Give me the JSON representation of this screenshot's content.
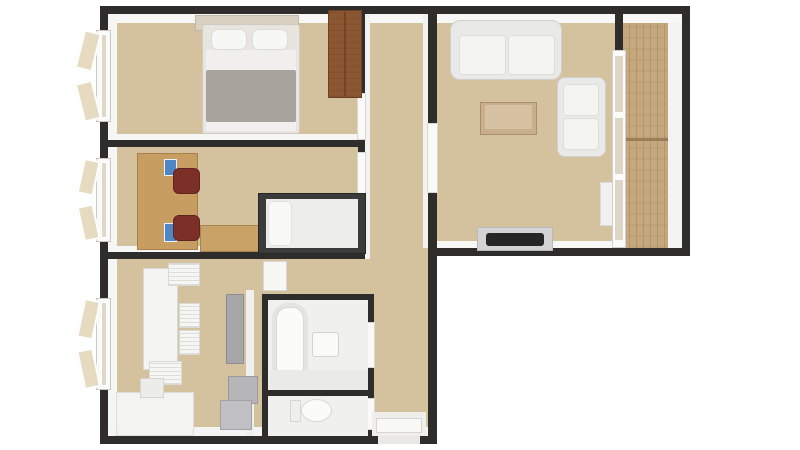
{
  "meta": {
    "description": "3D rendered top-down apartment floor plan, L-shaped layout, no visible text",
    "canvas": {
      "width": 800,
      "height": 450
    }
  },
  "palette": {
    "background": "#ffffff",
    "wall": "#2e2d2b",
    "wall_face": "#f5f5f3",
    "floor": "#d4c29e",
    "balcony_wood": "#c6a87f",
    "furniture_white": "#f4f4f2",
    "wardrobe_brown": "#8a5732",
    "desk_wood": "#c89d61",
    "chair_maroon": "#7c2f27",
    "accent_blue": "#4f86c6",
    "blanket_gray": "#a8a39c",
    "appliance_gray": "#a7a7a9",
    "tv_black": "#262626"
  },
  "rooms": [
    {
      "id": "bedroom",
      "position": "top-left",
      "furniture": [
        "double-bed",
        "two-pillows",
        "gray-blanket",
        "headboard-shelf",
        "wardrobe",
        "casement-window"
      ]
    },
    {
      "id": "study",
      "position": "middle-left",
      "furniture": [
        "long-desk",
        "two-maroon-office-chairs",
        "blue-desk-items",
        "single-bed-dark-frame",
        "wooden-chest",
        "casement-window"
      ]
    },
    {
      "id": "kitchen",
      "position": "bottom-left",
      "furniture": [
        "white-dining-table",
        "four-white-chairs",
        "kitchen-counter",
        "sink-unit",
        "fridge",
        "appliance-boxes",
        "casement-window"
      ]
    },
    {
      "id": "bathroom",
      "position": "bottom-center",
      "furniture": [
        "bathtub",
        "sink",
        "vanity-shelf"
      ]
    },
    {
      "id": "wc",
      "position": "bottom-center-lower",
      "furniture": [
        "toilet"
      ]
    },
    {
      "id": "hallway",
      "position": "center",
      "furniture": [
        "open-door-panels",
        "entrance-door"
      ]
    },
    {
      "id": "living-room",
      "position": "top-right",
      "furniture": [
        "three-seat-sofa",
        "coffee-table",
        "armchair",
        "tv-on-stand",
        "window-sill-cabinet"
      ]
    },
    {
      "id": "balcony",
      "position": "far-right",
      "furniture": [
        "wood-plank-floor",
        "glass-wall",
        "railing"
      ]
    }
  ],
  "elements": [
    {
      "name": "floor-main",
      "x": 108,
      "y": 14,
      "w": 320,
      "h": 422,
      "fill": "#d4c29e"
    },
    {
      "name": "floor-living",
      "x": 437,
      "y": 14,
      "w": 178,
      "h": 234,
      "fill": "#d4c29e"
    },
    {
      "name": "floor-balcony-wood",
      "x": 622,
      "y": 22,
      "w": 46,
      "h": 226,
      "fill": "#c6a87f",
      "texture": "planks"
    },
    {
      "name": "balcony-railing-face",
      "x": 668,
      "y": 16,
      "w": 14,
      "h": 232,
      "fill": "#f3f3f2"
    },
    {
      "name": "balcony-plank-divider",
      "x": 622,
      "y": 138,
      "w": 46,
      "h": 3,
      "fill": "#9b7e59"
    },
    {
      "name": "wall-face-top",
      "x": 108,
      "y": 14,
      "w": 574,
      "h": 9,
      "fill": "#f7f7f5"
    },
    {
      "name": "wall-face-left",
      "x": 108,
      "y": 14,
      "w": 9,
      "h": 422,
      "fill": "#f5f5f3"
    },
    {
      "name": "wall-face-bottom",
      "x": 108,
      "y": 427,
      "w": 320,
      "h": 9,
      "fill": "#f4f4f2"
    },
    {
      "name": "wall-face-living-bottom",
      "x": 437,
      "y": 241,
      "w": 178,
      "h": 7,
      "fill": "#f7f7f5"
    },
    {
      "name": "wall-face-bedroom-study",
      "x": 108,
      "y": 134,
      "w": 250,
      "h": 6,
      "fill": "#f6f6f4"
    },
    {
      "name": "wall-face-study-kitchen",
      "x": 108,
      "y": 246,
      "w": 250,
      "h": 6,
      "fill": "#f6f6f4"
    },
    {
      "name": "wall-face-hall-left",
      "x": 365,
      "y": 14,
      "w": 5,
      "h": 245,
      "fill": "#f2f2f0"
    },
    {
      "name": "wall-face-hall-right",
      "x": 423,
      "y": 14,
      "w": 5,
      "h": 234,
      "fill": "#f2f2f0"
    },
    {
      "name": "wall-face-kitchen-partition",
      "x": 246,
      "y": 290,
      "w": 8,
      "h": 146,
      "fill": "#efefed"
    },
    {
      "name": "wall-top",
      "x": 100,
      "y": 6,
      "w": 590,
      "h": 8
    },
    {
      "name": "wall-left",
      "x": 100,
      "y": 6,
      "w": 8,
      "h": 438
    },
    {
      "name": "wall-bottom",
      "x": 100,
      "y": 436,
      "w": 337,
      "h": 8
    },
    {
      "name": "wall-hall-right-full",
      "x": 428,
      "y": 14,
      "w": 9,
      "h": 430
    },
    {
      "name": "wall-bottom-right-block",
      "x": 428,
      "y": 248,
      "w": 262,
      "h": 8
    },
    {
      "name": "wall-right-outer",
      "x": 682,
      "y": 6,
      "w": 8,
      "h": 250
    },
    {
      "name": "wall-bedroom-study",
      "x": 108,
      "y": 140,
      "w": 250,
      "h": 7
    },
    {
      "name": "wall-study-kitchen",
      "x": 108,
      "y": 252,
      "w": 250,
      "h": 7
    },
    {
      "name": "wall-hall-left",
      "x": 358,
      "y": 14,
      "w": 7,
      "h": 245
    },
    {
      "name": "wall-balcony-stub",
      "x": 615,
      "y": 6,
      "w": 8,
      "h": 44
    },
    {
      "name": "wall-bath-top",
      "x": 262,
      "y": 294,
      "w": 112,
      "h": 6
    },
    {
      "name": "wall-bath-left",
      "x": 262,
      "y": 294,
      "w": 6,
      "h": 142
    },
    {
      "name": "wall-bath-right",
      "x": 368,
      "y": 294,
      "w": 6,
      "h": 142
    },
    {
      "name": "wall-bath-divider",
      "x": 262,
      "y": 390,
      "w": 112,
      "h": 6
    },
    {
      "name": "door-bedroom-panel",
      "x": 357,
      "y": 93,
      "w": 9,
      "h": 47,
      "fill": "#f9f9f8",
      "stroke": "#d8d8d6"
    },
    {
      "name": "door-study-panel",
      "x": 357,
      "y": 152,
      "w": 9,
      "h": 42,
      "fill": "#f9f9f8",
      "stroke": "#d8d8d6"
    },
    {
      "name": "door-living-panel",
      "x": 427,
      "y": 123,
      "w": 11,
      "h": 70,
      "fill": "#f9f9f8",
      "stroke": "#d8d8d6"
    },
    {
      "name": "door-bathroom-panel",
      "x": 366,
      "y": 322,
      "w": 9,
      "h": 46,
      "fill": "#f9f9f8",
      "stroke": "#d8d8d6"
    },
    {
      "name": "door-wc-panel",
      "x": 366,
      "y": 398,
      "w": 9,
      "h": 32,
      "fill": "#f9f9f8",
      "stroke": "#d8d8d6"
    },
    {
      "name": "hall-open-door-panel",
      "x": 263,
      "y": 261,
      "w": 24,
      "h": 30,
      "fill": "#f7f7f5",
      "stroke": "#d8d8d6"
    },
    {
      "name": "entrance-floor",
      "x": 372,
      "y": 412,
      "w": 54,
      "h": 24,
      "fill": "#efeeea"
    },
    {
      "name": "entrance-door-panel",
      "x": 376,
      "y": 418,
      "w": 46,
      "h": 15,
      "fill": "#f8f8f7",
      "stroke": "#d5d5d3"
    },
    {
      "name": "entrance-threshold",
      "x": 378,
      "y": 436,
      "w": 42,
      "h": 8,
      "fill": "#e9e8e5"
    },
    {
      "name": "bedroom-window-frame",
      "x": 96,
      "y": 30,
      "w": 15,
      "h": 92,
      "fill": "#fafaf9",
      "stroke": "#c9c9c7"
    },
    {
      "name": "bedroom-window-glass",
      "x": 101,
      "y": 34,
      "w": 6,
      "h": 84,
      "fill": "#dfd8c6",
      "stroke": "#ffffff"
    },
    {
      "name": "bedroom-window-sash-top",
      "x": 79,
      "y": 33,
      "w": 18,
      "h": 40,
      "fill": "#e6dac1",
      "stroke": "#ffffff",
      "bw": 2,
      "rot": 14
    },
    {
      "name": "bedroom-window-sash-bottom",
      "x": 79,
      "y": 79,
      "w": 18,
      "h": 40,
      "fill": "#e6dac1",
      "stroke": "#ffffff",
      "bw": 2,
      "rot": -14
    },
    {
      "name": "study-window-frame",
      "x": 96,
      "y": 158,
      "w": 15,
      "h": 84,
      "fill": "#fafaf9",
      "stroke": "#c9c9c7"
    },
    {
      "name": "study-window-glass",
      "x": 101,
      "y": 162,
      "w": 6,
      "h": 76,
      "fill": "#dfd8c6",
      "stroke": "#ffffff"
    },
    {
      "name": "study-window-sash-top",
      "x": 80,
      "y": 161,
      "w": 17,
      "h": 36,
      "fill": "#e6dac1",
      "stroke": "#ffffff",
      "bw": 2,
      "rot": 12
    },
    {
      "name": "study-window-sash-bottom",
      "x": 80,
      "y": 203,
      "w": 17,
      "h": 36,
      "fill": "#e6dac1",
      "stroke": "#ffffff",
      "bw": 2,
      "rot": -12
    },
    {
      "name": "kitchen-window-frame",
      "x": 96,
      "y": 298,
      "w": 15,
      "h": 92,
      "fill": "#fafaf9",
      "stroke": "#c9c9c7"
    },
    {
      "name": "kitchen-window-glass",
      "x": 101,
      "y": 302,
      "w": 6,
      "h": 84,
      "fill": "#dfd8c6",
      "stroke": "#ffffff"
    },
    {
      "name": "kitchen-window-sash-top",
      "x": 80,
      "y": 301,
      "w": 17,
      "h": 40,
      "fill": "#e6dac1",
      "stroke": "#ffffff",
      "bw": 2,
      "rot": 12
    },
    {
      "name": "kitchen-window-sash-bottom",
      "x": 80,
      "y": 347,
      "w": 17,
      "h": 40,
      "fill": "#e6dac1",
      "stroke": "#ffffff",
      "bw": 2,
      "rot": -12
    },
    {
      "name": "headboard-shelf",
      "x": 195,
      "y": 15,
      "w": 104,
      "h": 16,
      "fill": "#d9d0c1",
      "stroke": "#c2b8a8"
    },
    {
      "name": "double-bed-base",
      "x": 202,
      "y": 24,
      "w": 98,
      "h": 110,
      "fill": "#e8e4de",
      "stroke": "#cfcac3",
      "r": 3
    },
    {
      "name": "double-bed-sheet",
      "x": 206,
      "y": 50,
      "w": 90,
      "h": 26,
      "fill": "#f0efed"
    },
    {
      "name": "double-bed-blanket",
      "x": 206,
      "y": 70,
      "w": 90,
      "h": 52,
      "fill": "#a8a39c",
      "r": 2
    },
    {
      "name": "double-bed-foot",
      "x": 206,
      "y": 122,
      "w": 90,
      "h": 9,
      "fill": "#f1f0ee"
    },
    {
      "name": "bed-pillow-left",
      "x": 211,
      "y": 29,
      "w": 36,
      "h": 21,
      "fill": "#f7f7f6",
      "stroke": "#dcdcda",
      "r": 7
    },
    {
      "name": "bed-pillow-right",
      "x": 252,
      "y": 29,
      "w": 36,
      "h": 21,
      "fill": "#f7f7f6",
      "stroke": "#dcdcda",
      "r": 7
    },
    {
      "name": "wardrobe",
      "x": 328,
      "y": 10,
      "w": 34,
      "h": 88,
      "fill": "#8a5732",
      "stroke": "#6b4123",
      "texture": "grain"
    },
    {
      "name": "wardrobe-divider",
      "x": 344,
      "y": 12,
      "w": 2,
      "h": 84,
      "fill": "#6e4527"
    },
    {
      "name": "study-desk",
      "x": 137,
      "y": 153,
      "w": 61,
      "h": 97,
      "fill": "#c89d61",
      "stroke": "#a97f49"
    },
    {
      "name": "desk-blue-item-1",
      "x": 164,
      "y": 159,
      "w": 13,
      "h": 17,
      "fill": "#4f86c6",
      "stroke": "#eef2f8"
    },
    {
      "name": "desk-blue-item-2",
      "x": 164,
      "y": 223,
      "w": 13,
      "h": 19,
      "fill": "#4f86c6",
      "stroke": "#eef2f8"
    },
    {
      "name": "office-chair-1",
      "x": 173,
      "y": 168,
      "w": 27,
      "h": 26,
      "fill": "#7c2f27",
      "stroke": "#5f241e",
      "r": 6
    },
    {
      "name": "office-chair-2",
      "x": 173,
      "y": 215,
      "w": 27,
      "h": 26,
      "fill": "#7c2f27",
      "stroke": "#5f241e",
      "r": 6
    },
    {
      "name": "wooden-chest",
      "x": 200,
      "y": 225,
      "w": 60,
      "h": 27,
      "fill": "#c9a267",
      "stroke": "#ab854f"
    },
    {
      "name": "single-bed-frame",
      "x": 258,
      "y": 193,
      "w": 108,
      "h": 61,
      "fill": "#3b3b3b",
      "stroke": "#262626"
    },
    {
      "name": "single-bed-mattress",
      "x": 266,
      "y": 199,
      "w": 92,
      "h": 49,
      "fill": "#ededeb"
    },
    {
      "name": "single-bed-pillow",
      "x": 268,
      "y": 201,
      "w": 24,
      "h": 45,
      "fill": "#f8f8f7",
      "stroke": "#e0e0de",
      "r": 5
    },
    {
      "name": "dining-table",
      "x": 143,
      "y": 268,
      "w": 35,
      "h": 102,
      "fill": "#f4f4f2",
      "stroke": "#dadad8"
    },
    {
      "name": "dining-chair-head",
      "x": 168,
      "y": 263,
      "w": 32,
      "h": 23,
      "fill": "#f6f6f4",
      "stroke": "#d9d9d7",
      "texture": "slats"
    },
    {
      "name": "dining-chair-right-1",
      "x": 179,
      "y": 303,
      "w": 21,
      "h": 25,
      "fill": "#f6f6f4",
      "stroke": "#d9d9d7",
      "texture": "slats"
    },
    {
      "name": "dining-chair-right-2",
      "x": 179,
      "y": 330,
      "w": 21,
      "h": 25,
      "fill": "#f6f6f4",
      "stroke": "#d9d9d7",
      "texture": "slats"
    },
    {
      "name": "dining-chair-foot",
      "x": 149,
      "y": 361,
      "w": 33,
      "h": 24,
      "fill": "#f6f6f4",
      "stroke": "#d9d9d7",
      "texture": "slats"
    },
    {
      "name": "kitchen-counter",
      "x": 116,
      "y": 392,
      "w": 78,
      "h": 44,
      "fill": "#f3f3f1",
      "stroke": "#dddddb"
    },
    {
      "name": "kitchen-sink-unit",
      "x": 140,
      "y": 378,
      "w": 24,
      "h": 20,
      "fill": "#ececea",
      "stroke": "#d5d5d3"
    },
    {
      "name": "fridge",
      "x": 226,
      "y": 294,
      "w": 18,
      "h": 70,
      "fill": "#a7a7a9",
      "stroke": "#8e8e90"
    },
    {
      "name": "appliance-box-1",
      "x": 228,
      "y": 376,
      "w": 30,
      "h": 28,
      "fill": "#b6b6b8",
      "stroke": "#9a9a9c"
    },
    {
      "name": "appliance-box-2",
      "x": 220,
      "y": 400,
      "w": 32,
      "h": 30,
      "fill": "#c0c0c2",
      "stroke": "#a2a2a4"
    },
    {
      "name": "bathroom-floor",
      "x": 268,
      "y": 300,
      "w": 100,
      "h": 90,
      "fill": "#f0f0ee"
    },
    {
      "name": "wc-floor",
      "x": 268,
      "y": 396,
      "w": 100,
      "h": 40,
      "fill": "#f0f0ee"
    },
    {
      "name": "bathtub",
      "x": 272,
      "y": 303,
      "w": 36,
      "h": 80,
      "fill": "#e4e4e2",
      "r": 16
    },
    {
      "name": "bathtub-inner",
      "x": 276,
      "y": 307,
      "w": 28,
      "h": 72,
      "fill": "#fbfbfa",
      "stroke": "#d8d8d6",
      "r": 12
    },
    {
      "name": "bath-vanity-shelf",
      "x": 270,
      "y": 370,
      "w": 98,
      "h": 20,
      "fill": "#eaeae8"
    },
    {
      "name": "bathroom-sink",
      "x": 312,
      "y": 332,
      "w": 27,
      "h": 25,
      "fill": "#fafaf9",
      "stroke": "#d2d2d0",
      "r": 3
    },
    {
      "name": "toilet-tank",
      "x": 290,
      "y": 400,
      "w": 11,
      "h": 22,
      "fill": "#efefed",
      "stroke": "#d5d5d3"
    },
    {
      "name": "toilet-bowl",
      "x": 301,
      "y": 399,
      "w": 31,
      "h": 23,
      "fill": "#fbfbfa",
      "stroke": "#d8d8d6",
      "r": "50%"
    },
    {
      "name": "sofa-base",
      "x": 450,
      "y": 20,
      "w": 112,
      "h": 60,
      "fill": "#e9e9e7",
      "stroke": "#d0d0ce",
      "r": 10
    },
    {
      "name": "sofa-cushion-left",
      "x": 459,
      "y": 35,
      "w": 47,
      "h": 40,
      "fill": "#f4f4f2",
      "stroke": "#dededc",
      "r": 4
    },
    {
      "name": "sofa-cushion-right",
      "x": 508,
      "y": 35,
      "w": 47,
      "h": 40,
      "fill": "#f4f4f2",
      "stroke": "#dededc",
      "r": 4
    },
    {
      "name": "coffee-table",
      "x": 480,
      "y": 102,
      "w": 57,
      "h": 33,
      "fill": "#c9ae8c",
      "stroke": "#ab8e6c"
    },
    {
      "name": "coffee-table-top",
      "x": 485,
      "y": 105,
      "w": 47,
      "h": 24,
      "fill": "#d6c1a3"
    },
    {
      "name": "armchair-base",
      "x": 557,
      "y": 77,
      "w": 49,
      "h": 80,
      "fill": "#e9e9e7",
      "stroke": "#d0d0ce",
      "r": 8
    },
    {
      "name": "armchair-cushion-1",
      "x": 563,
      "y": 84,
      "w": 36,
      "h": 32,
      "fill": "#f4f4f2",
      "stroke": "#dededc",
      "r": 4
    },
    {
      "name": "armchair-cushion-2",
      "x": 563,
      "y": 118,
      "w": 36,
      "h": 32,
      "fill": "#f4f4f2",
      "stroke": "#dededc",
      "r": 4
    },
    {
      "name": "tv-stand",
      "x": 477,
      "y": 227,
      "w": 76,
      "h": 24,
      "fill": "#d3d3d5",
      "stroke": "#b9b9bb"
    },
    {
      "name": "tv-screen",
      "x": 486,
      "y": 233,
      "w": 58,
      "h": 13,
      "fill": "#262626",
      "r": 3
    },
    {
      "name": "window-sill-cabinet",
      "x": 600,
      "y": 182,
      "w": 20,
      "h": 44,
      "fill": "#f1f1ef",
      "stroke": "#dcdcda"
    },
    {
      "name": "balcony-glass-wall",
      "x": 612,
      "y": 50,
      "w": 14,
      "h": 198,
      "fill": "#fbfbfa",
      "stroke": "#cfcfcd"
    },
    {
      "name": "balcony-glass-pane-1",
      "x": 615,
      "y": 56,
      "w": 8,
      "h": 56,
      "fill": "#ddd6c6"
    },
    {
      "name": "balcony-glass-pane-2",
      "x": 615,
      "y": 118,
      "w": 8,
      "h": 56,
      "fill": "#ddd6c6"
    },
    {
      "name": "balcony-glass-pane-3",
      "x": 615,
      "y": 180,
      "w": 8,
      "h": 60,
      "fill": "#ddd6c6"
    }
  ]
}
